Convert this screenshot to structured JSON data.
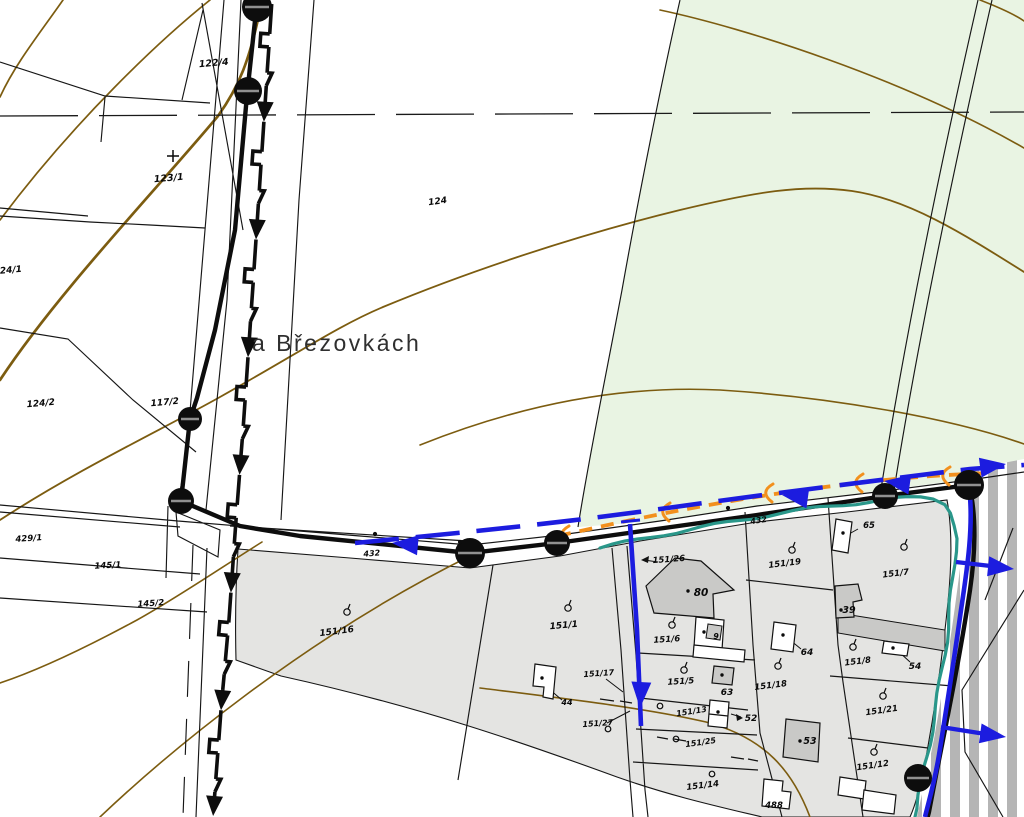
{
  "map": {
    "place_name": "a Březovkách",
    "road_labels": [
      {
        "t": "432",
        "x": 372,
        "y": 556,
        "r": -4,
        "s": 8
      },
      {
        "t": "432",
        "x": 759,
        "y": 523,
        "r": -9,
        "s": 8
      }
    ],
    "parcel_labels": [
      {
        "t": "122/4",
        "x": 214,
        "y": 66,
        "r": -5,
        "s": 9.5
      },
      {
        "t": "123/1",
        "x": 169,
        "y": 181,
        "r": -5,
        "s": 9.5
      },
      {
        "t": "124/1",
        "x": 8,
        "y": 273,
        "r": -5,
        "s": 9
      },
      {
        "t": "124/2",
        "x": 41,
        "y": 406,
        "r": -5,
        "s": 9
      },
      {
        "t": "117/2",
        "x": 165,
        "y": 405,
        "r": -5,
        "s": 9
      },
      {
        "t": "124",
        "x": 438,
        "y": 204,
        "r": -8,
        "s": 9
      },
      {
        "t": "429/1",
        "x": 29,
        "y": 541,
        "r": -4,
        "s": 8.5
      },
      {
        "t": "145/1",
        "x": 108,
        "y": 568,
        "r": -3,
        "s": 8.5
      },
      {
        "t": "145/2",
        "x": 151,
        "y": 606,
        "r": -4,
        "s": 8.5
      },
      {
        "t": "151/16",
        "x": 337,
        "y": 634,
        "r": -7,
        "s": 9
      },
      {
        "t": "151/1",
        "x": 564,
        "y": 628,
        "r": -5,
        "s": 9
      },
      {
        "t": "151/17",
        "x": 599,
        "y": 676,
        "r": -4,
        "s": 8
      },
      {
        "t": "151/27",
        "x": 598,
        "y": 726,
        "r": -4,
        "s": 8
      },
      {
        "t": "151/26",
        "x": 669,
        "y": 562,
        "r": -4,
        "s": 8.5
      },
      {
        "t": "151/19",
        "x": 785,
        "y": 566,
        "r": -7,
        "s": 8.5
      },
      {
        "t": "151/7",
        "x": 896,
        "y": 576,
        "r": -7,
        "s": 8.5
      },
      {
        "t": "151/6",
        "x": 667,
        "y": 642,
        "r": -4,
        "s": 8.5
      },
      {
        "t": "151/5",
        "x": 681,
        "y": 684,
        "r": -4,
        "s": 8.5
      },
      {
        "t": "151/18",
        "x": 771,
        "y": 688,
        "r": -7,
        "s": 8.5
      },
      {
        "t": "151/8",
        "x": 858,
        "y": 664,
        "r": -7,
        "s": 8.5
      },
      {
        "t": "151/21",
        "x": 882,
        "y": 713,
        "r": -8,
        "s": 8.5
      },
      {
        "t": "151/12",
        "x": 873,
        "y": 768,
        "r": -8,
        "s": 8.5
      },
      {
        "t": "151/13",
        "x": 692,
        "y": 714,
        "r": -9,
        "s": 8
      },
      {
        "t": "151/25",
        "x": 701,
        "y": 745,
        "r": -8,
        "s": 8
      },
      {
        "t": "151/14",
        "x": 703,
        "y": 788,
        "r": -7,
        "s": 8.5
      }
    ],
    "building_labels": [
      {
        "t": "80",
        "x": 701,
        "y": 596,
        "s": 10.5
      },
      {
        "t": "9",
        "x": 716,
        "y": 639,
        "s": 8
      },
      {
        "t": "39",
        "x": 849,
        "y": 613,
        "s": 9.5
      },
      {
        "t": "64",
        "x": 807,
        "y": 655,
        "s": 9
      },
      {
        "t": "54",
        "x": 915,
        "y": 669,
        "s": 9
      },
      {
        "t": "63",
        "x": 727,
        "y": 695,
        "s": 9
      },
      {
        "t": "52",
        "x": 751,
        "y": 721,
        "s": 9
      },
      {
        "t": "53",
        "x": 810,
        "y": 744,
        "s": 9.5
      },
      {
        "t": "488",
        "x": 774,
        "y": 808,
        "s": 8.5
      },
      {
        "t": "44",
        "x": 567,
        "y": 705,
        "s": 8
      },
      {
        "t": "65",
        "x": 869,
        "y": 528,
        "s": 8.5
      }
    ],
    "symbols": {
      "tree_symbols": [
        [
          347,
          612
        ],
        [
          568,
          608
        ],
        [
          792,
          550
        ],
        [
          904,
          547
        ],
        [
          672,
          625
        ],
        [
          684,
          670
        ],
        [
          778,
          666
        ],
        [
          853,
          647
        ],
        [
          883,
          696
        ],
        [
          874,
          752
        ]
      ],
      "circle_marks": [
        [
          660,
          706
        ],
        [
          676,
          739
        ],
        [
          712,
          774
        ],
        [
          608,
          729
        ]
      ],
      "plus_marks": [
        [
          173,
          156
        ]
      ]
    }
  },
  "colors": {
    "green_area": "#e9f4e3",
    "urban_area": "#e4e4e2",
    "building_dark": "#c9c9c7",
    "stripe_gray": "#b5b5b5",
    "contour_brown": "#7c5c10",
    "water_blue": "#1c1cdf",
    "gas_orange": "#f2901d",
    "drain_teal": "#2a978a",
    "line_black": "#0d0d0d"
  }
}
